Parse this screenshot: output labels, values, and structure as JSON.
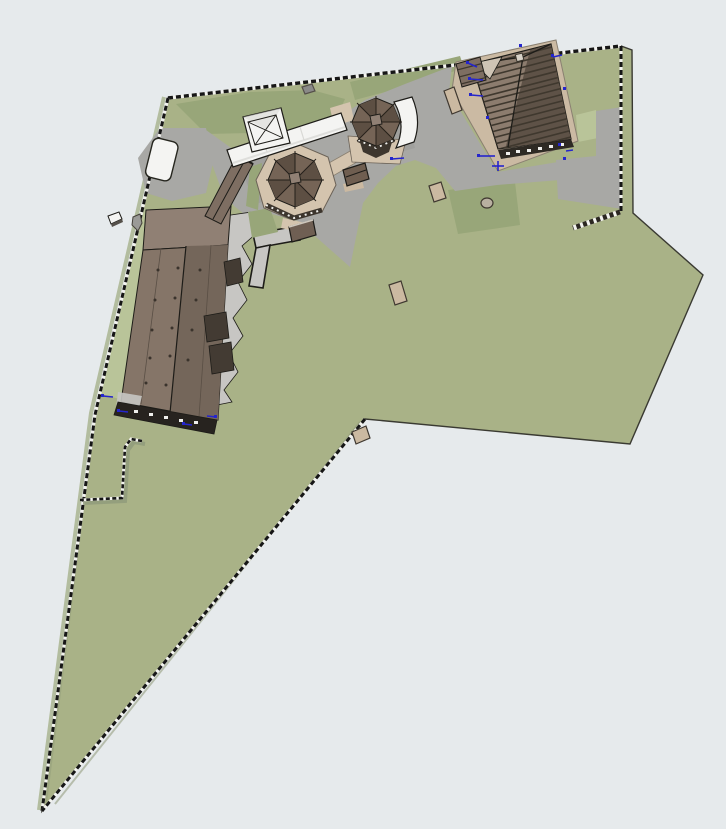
{
  "canvas": {
    "width": 726,
    "height": 829
  },
  "colors": {
    "background": "#e6eaec",
    "outline": "#3a3a32",
    "ink": "#1d1c18",
    "grass": "#a9b287",
    "grassDark": "#98a679",
    "grassLight": "#b9c499",
    "terrainEdge": "#b3bd9f",
    "paving": "#a8a8a5",
    "pavingLight": "#c7c6c3",
    "pavingDark": "#8f8f8c",
    "tan": "#d4c4ae",
    "benchTan": "#cbb9a1",
    "white": "#f4f4f2",
    "whiteShade": "#d9d9d6",
    "roofMain": "#857568",
    "roofUpper": "#908074",
    "roofWing": "#7e6e62",
    "roofPanelDark": "#74665a",
    "roofSideDark": "#433b33",
    "baseDark": "#27231f",
    "octRoof": "#756456",
    "octRoofDark": "#5d4f43",
    "octWall": "#3c352d",
    "houseRoof": "#8c7c6e",
    "houseRoofDark": "#5e5247",
    "houseStripe": "#3f382e",
    "eaveTan": "#cbbaa3",
    "wallDark": "#2e2a24",
    "fenceDark": "#161616",
    "fenceLight": "#f3f3ef",
    "markerBlue": "#2525cc",
    "kioskBrown": "#6f5e50",
    "shedBrown": "#6f5f53"
  },
  "scene": {
    "elements": [
      "site-parcel",
      "boundary-fence",
      "inner-fence",
      "retaining-wall",
      "main-hall",
      "chapel-wing",
      "pavilion-a",
      "pavilion-b",
      "white-service-building",
      "skylight-structure",
      "rounded-shed",
      "white-annex",
      "house",
      "kiosk",
      "garden-shed",
      "paved-plaza",
      "light-apron",
      "l-path",
      "tan-paths",
      "benches",
      "selection-markers"
    ]
  }
}
